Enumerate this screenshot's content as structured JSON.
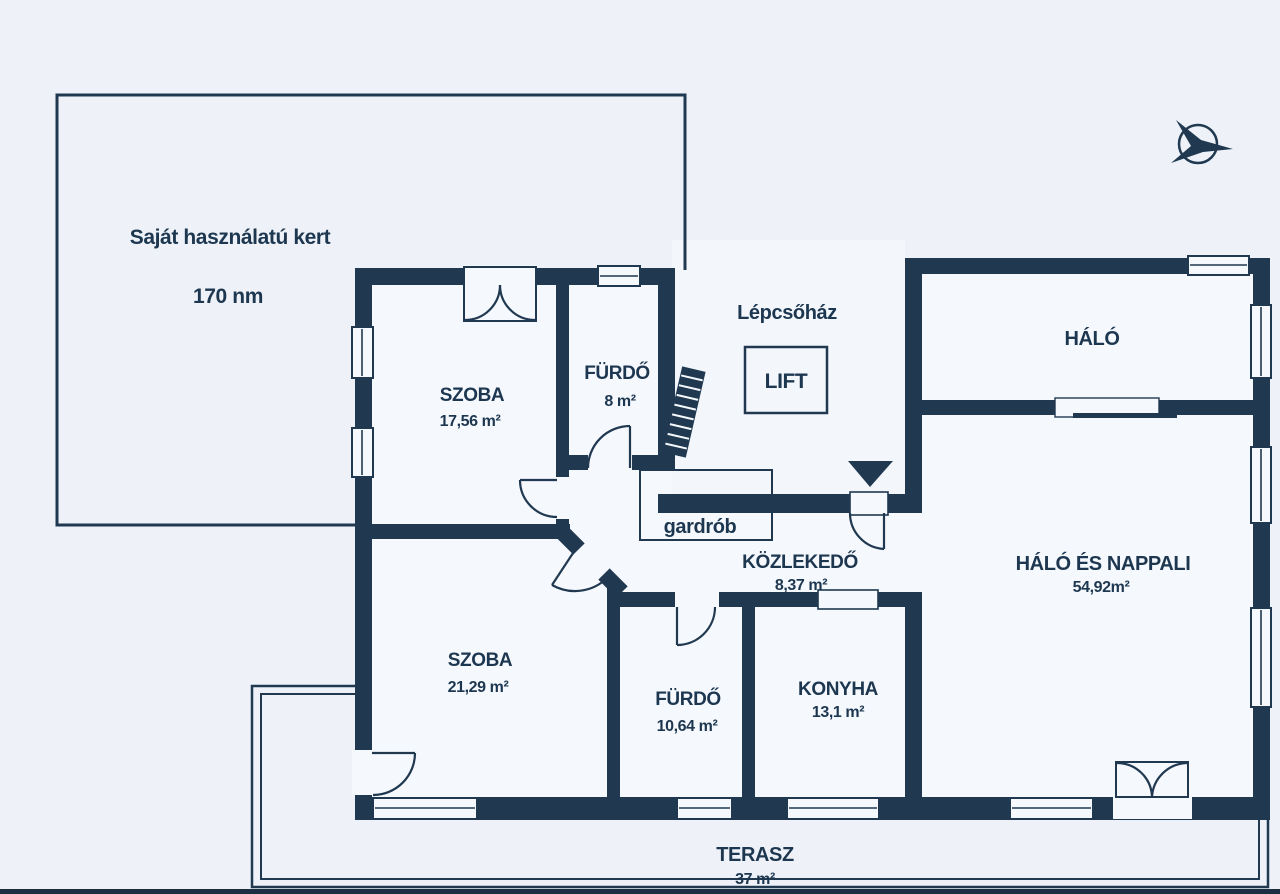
{
  "plan_title": "apartment-floorplan",
  "colors": {
    "wall": "#203950",
    "text": "#1d3750",
    "background": "#eef2f8",
    "room_fill": "#f5f8fd"
  },
  "garden": {
    "label": "Saját használatú kert",
    "area": "170 nm"
  },
  "staircase": {
    "label": "Lépcsőház",
    "lift_label": "LIFT"
  },
  "wardrobe": {
    "label": "gardrób"
  },
  "rooms": [
    {
      "id": "szoba-1",
      "name": "SZOBA",
      "area": "17,56 m²"
    },
    {
      "id": "furdo-1",
      "name": "FÜRDŐ",
      "area": "8 m²"
    },
    {
      "id": "halo",
      "name": "HÁLÓ",
      "area": ""
    },
    {
      "id": "kozlekedo",
      "name": "KÖZLEKEDŐ",
      "area": "8,37 m²"
    },
    {
      "id": "szoba-2",
      "name": "SZOBA",
      "area": "21,29 m²"
    },
    {
      "id": "furdo-2",
      "name": "FÜRDŐ",
      "area": "10,64 m²"
    },
    {
      "id": "konyha",
      "name": "KONYHA",
      "area": "13,1 m²"
    },
    {
      "id": "halo-nappali",
      "name": "HÁLÓ ÉS NAPPALI",
      "area": "54,92m²"
    },
    {
      "id": "terasz",
      "name": "TERASZ",
      "area": "37 m²"
    }
  ],
  "icons": {
    "compass": "north-arrow",
    "entrance_marker": "entrance-triangle",
    "stairs": "staircase-hatch"
  }
}
